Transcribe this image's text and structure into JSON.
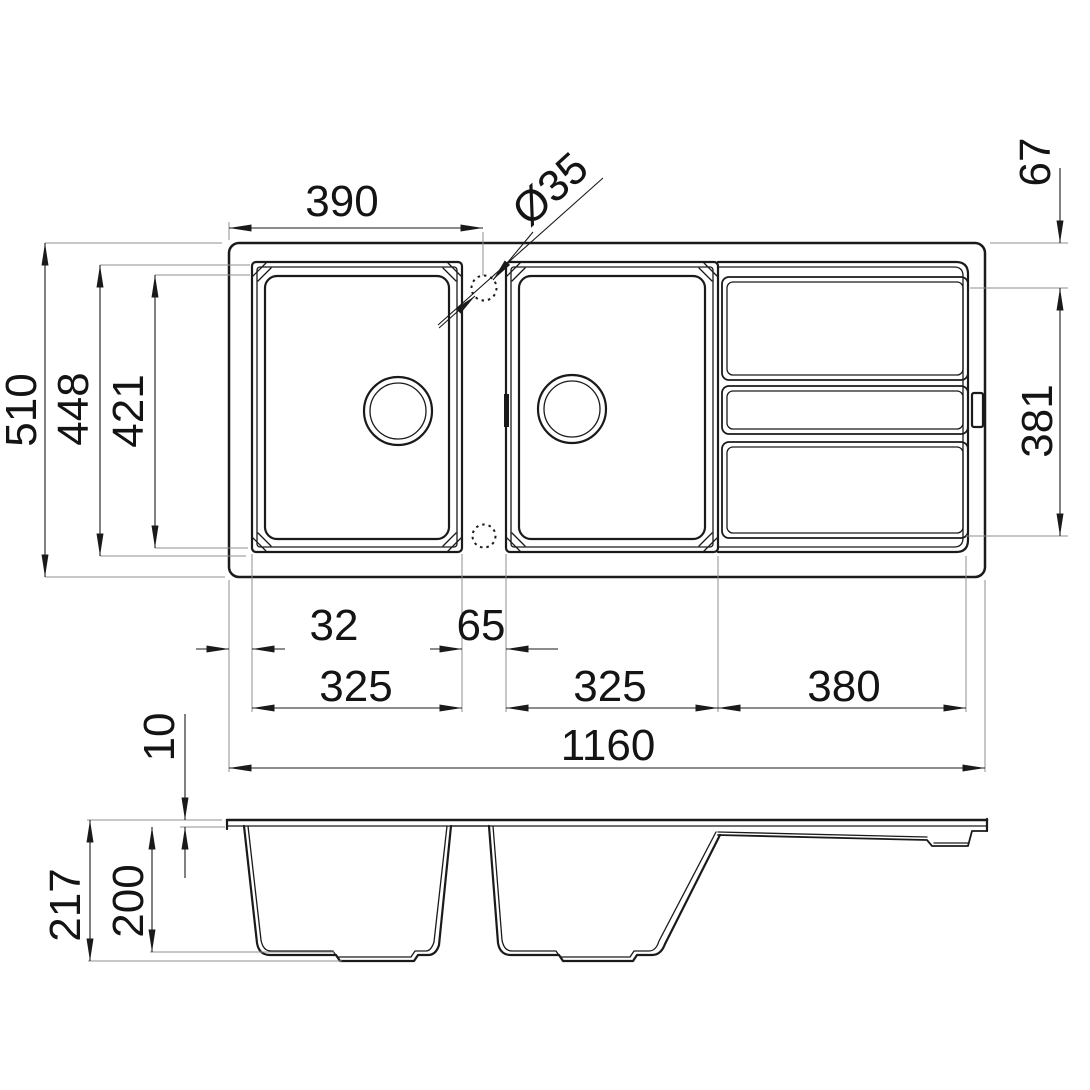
{
  "colors": {
    "line": "#1a1a1a",
    "construction": "#8f8f8f"
  },
  "dimensions": {
    "top": {
      "edge_to_tap_center": "390",
      "tap_hole_diameter": "Ø35",
      "edge_to_drainer": "67"
    },
    "left": {
      "overall_depth": "510",
      "bowl_outer_depth": "448",
      "bowl_inner_depth": "421"
    },
    "right": {
      "drainer_length": "381"
    },
    "bottom": {
      "edge_to_bowl": "32",
      "between_bowls": "65",
      "bowl1_width": "325",
      "bowl2_width": "325",
      "drainer_width": "380",
      "overall_width": "1160"
    },
    "side": {
      "deck_thickness": "10",
      "overall_height": "217",
      "bowl_depth": "200"
    }
  }
}
